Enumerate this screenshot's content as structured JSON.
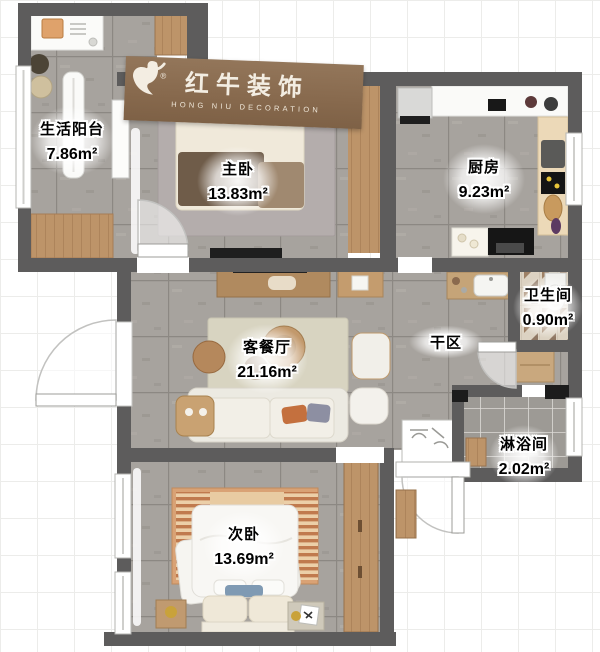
{
  "logo": {
    "brand": "红牛装饰",
    "subtitle": "HONG NIU DECORATION",
    "registered": "®",
    "icon": "bull-icon"
  },
  "rooms": {
    "balcony": {
      "name": "生活阳台",
      "area": "7.86m²"
    },
    "master_bedroom": {
      "name": "主卧",
      "area": "13.83m²"
    },
    "kitchen": {
      "name": "厨房",
      "area": "9.23m²"
    },
    "bathroom": {
      "name": "卫生间",
      "area": "0.90m²"
    },
    "living_dining": {
      "name": "客餐厅",
      "area": "21.16m²"
    },
    "dry_area": {
      "name": "干区",
      "area": ""
    },
    "shower": {
      "name": "淋浴间",
      "area": "2.02m²"
    },
    "second_bedroom": {
      "name": "次卧",
      "area": "13.69m²"
    }
  },
  "colors": {
    "wall": "#5d5c5c",
    "tile_floor": "#a7a39e",
    "banner": "#87694d",
    "wood": "#c0996c",
    "label_text": "#000000"
  }
}
